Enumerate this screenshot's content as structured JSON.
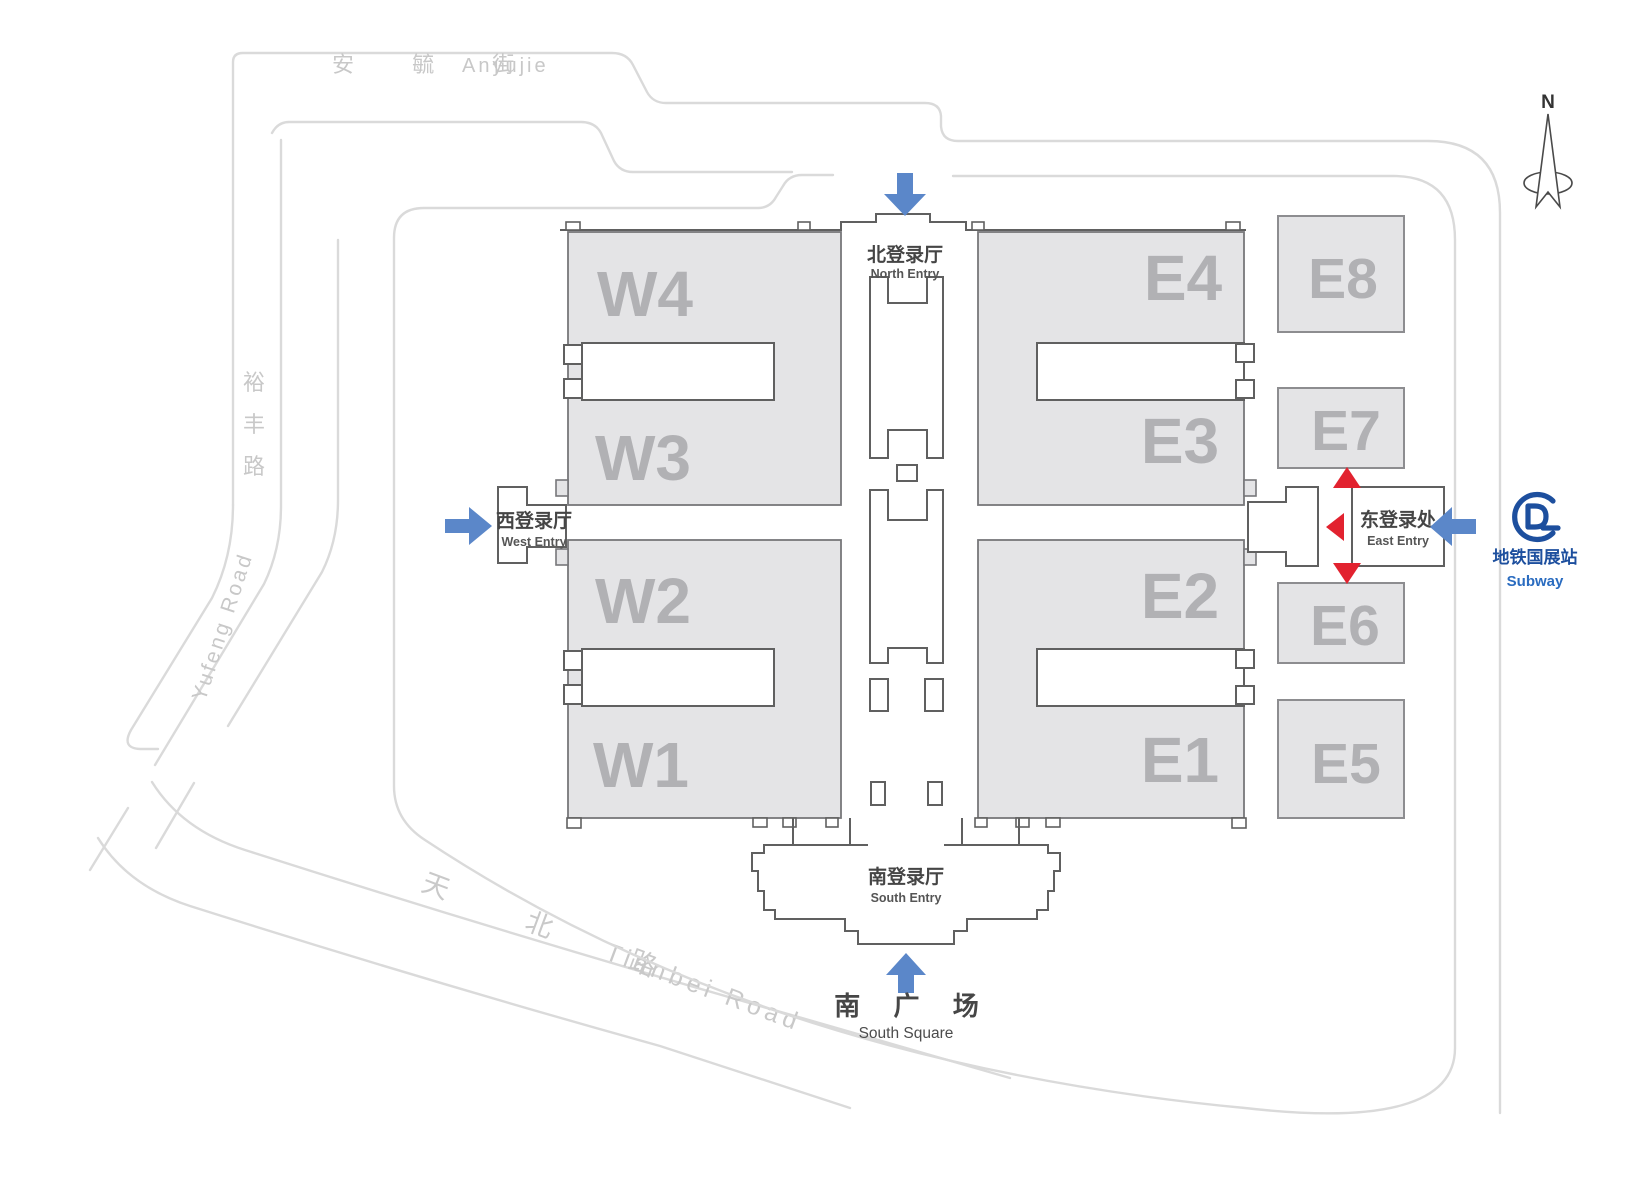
{
  "compass": {
    "label": "N"
  },
  "roads": {
    "anyujie": {
      "zh": "安 毓 街",
      "en": "Anyujie"
    },
    "yufeng": {
      "zh1": "裕",
      "zh2": "丰",
      "zh3": "路",
      "en": "Yufeng Road"
    },
    "tianbei": {
      "zh": "天 北 路",
      "en": "Tianbei Road"
    }
  },
  "halls": {
    "w4": "W4",
    "w3": "W3",
    "w2": "W2",
    "w1": "W1",
    "e4": "E4",
    "e3": "E3",
    "e2": "E2",
    "e1": "E1",
    "e8": "E8",
    "e7": "E7",
    "e6": "E6",
    "e5": "E5"
  },
  "entries": {
    "north": {
      "zh": "北登录厅",
      "en": "North Entry"
    },
    "west": {
      "zh": "西登录厅",
      "en": "West Entry"
    },
    "east": {
      "zh": "东登录处",
      "en": "East Entry"
    },
    "south": {
      "zh": "南登录厅",
      "en": "South Entry"
    }
  },
  "south_square": {
    "zh": "南 广 场",
    "en": "South Square"
  },
  "subway": {
    "zh": "地铁国展站",
    "en": "Subway"
  },
  "colors": {
    "arrow_blue": "#5b87c9",
    "arrow_red": "#e2222f",
    "subway_blue": "#1d4f9e",
    "subway_text_blue": "#2a6cc0",
    "hall_fill": "#e4e4e6",
    "hall_label_gray": "#b1b1b4",
    "building_outline": "#606060",
    "road_gray": "#dadada"
  }
}
